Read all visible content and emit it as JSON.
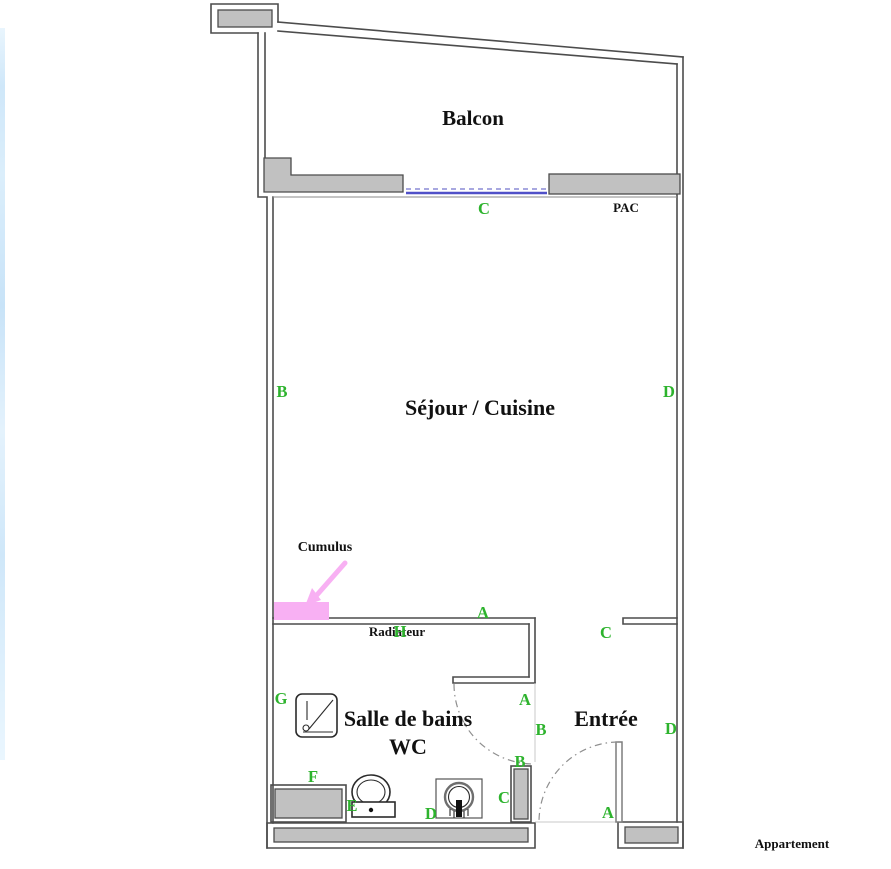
{
  "colors": {
    "green": "#2db32d",
    "pink": "#f8b0f3",
    "blueSolid": "#5050c8",
    "blueDash": "#a8a8e0",
    "wallFill": "#c1c1c1",
    "wallLine": "#4c4c4c",
    "ink": "#111111"
  },
  "rooms": {
    "balcon": "Balcon",
    "sejour_cuisine": "Séjour / Cuisine",
    "salle_de_bains": "Salle de bains",
    "wc": "WC",
    "entree": "Entrée"
  },
  "equipment": {
    "pac": "PAC",
    "cumulus": "Cumulus",
    "radiateur": "Radiateur"
  },
  "footer": {
    "apartment_label": "Appartement"
  },
  "markers": [
    {
      "letter": "C"
    },
    {
      "letter": "B"
    },
    {
      "letter": "D"
    },
    {
      "letter": "A"
    },
    {
      "letter": "C"
    },
    {
      "letter": "H"
    },
    {
      "letter": "G"
    },
    {
      "letter": "A"
    },
    {
      "letter": "B"
    },
    {
      "letter": "D"
    },
    {
      "letter": "B"
    },
    {
      "letter": "C"
    },
    {
      "letter": "F"
    },
    {
      "letter": "E"
    },
    {
      "letter": "D"
    },
    {
      "letter": "A"
    }
  ]
}
